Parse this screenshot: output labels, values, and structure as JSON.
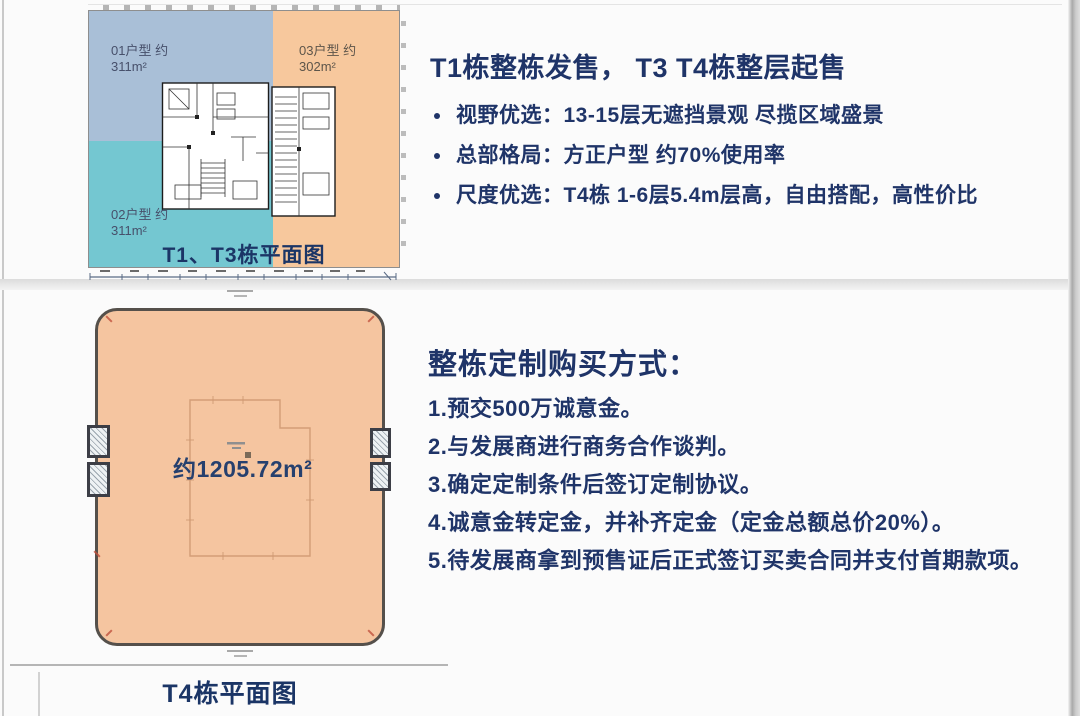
{
  "top_section": {
    "plan": {
      "caption": "T1、T3栋平面图",
      "units": [
        {
          "name": "01",
          "label_line1": "01户型 约",
          "label_line2": "311m²",
          "color": "#a9bfd7"
        },
        {
          "name": "02",
          "label_line1": "02户型 约",
          "label_line2": "311m²",
          "color": "#74c7d1"
        },
        {
          "name": "03",
          "label_line1": "03户型 约",
          "label_line2": "302m²",
          "color": "#f7c89d"
        }
      ]
    },
    "info": {
      "title": "T1栋整栋发售， T3 T4栋整层起售",
      "bullets": [
        "视野优选：13-15层无遮挡景观 尽揽区域盛景",
        "总部格局：方正户型 约70%使用率",
        "尺度优选：T4栋 1-6层5.4m层高，自由搭配，高性价比"
      ]
    }
  },
  "bottom_section": {
    "plan": {
      "area_label": "约1205.72m²",
      "caption": "T4栋平面图",
      "fill_color": "#f5c5a0"
    },
    "info": {
      "title": "整栋定制购买方式：",
      "steps": [
        "1.预交500万诚意金。",
        "2.与发展商进行商务合作谈判。",
        "3.确定定制条件后签订定制协议。",
        "4.诚意金转定金，并补齐定金（定金总额总价20%）。",
        "5.待发展商拿到预售证后正式签订买卖合同并支付首期款项。"
      ]
    }
  },
  "colors": {
    "text_navy": "#1f3468",
    "caption_navy": "#1b3566",
    "unit01_blue": "#a9bfd7",
    "unit02_teal": "#74c7d1",
    "unit03_peach": "#f7c89d",
    "t4_fill_peach": "#f5c5a0",
    "t4_border": "#55504b"
  }
}
